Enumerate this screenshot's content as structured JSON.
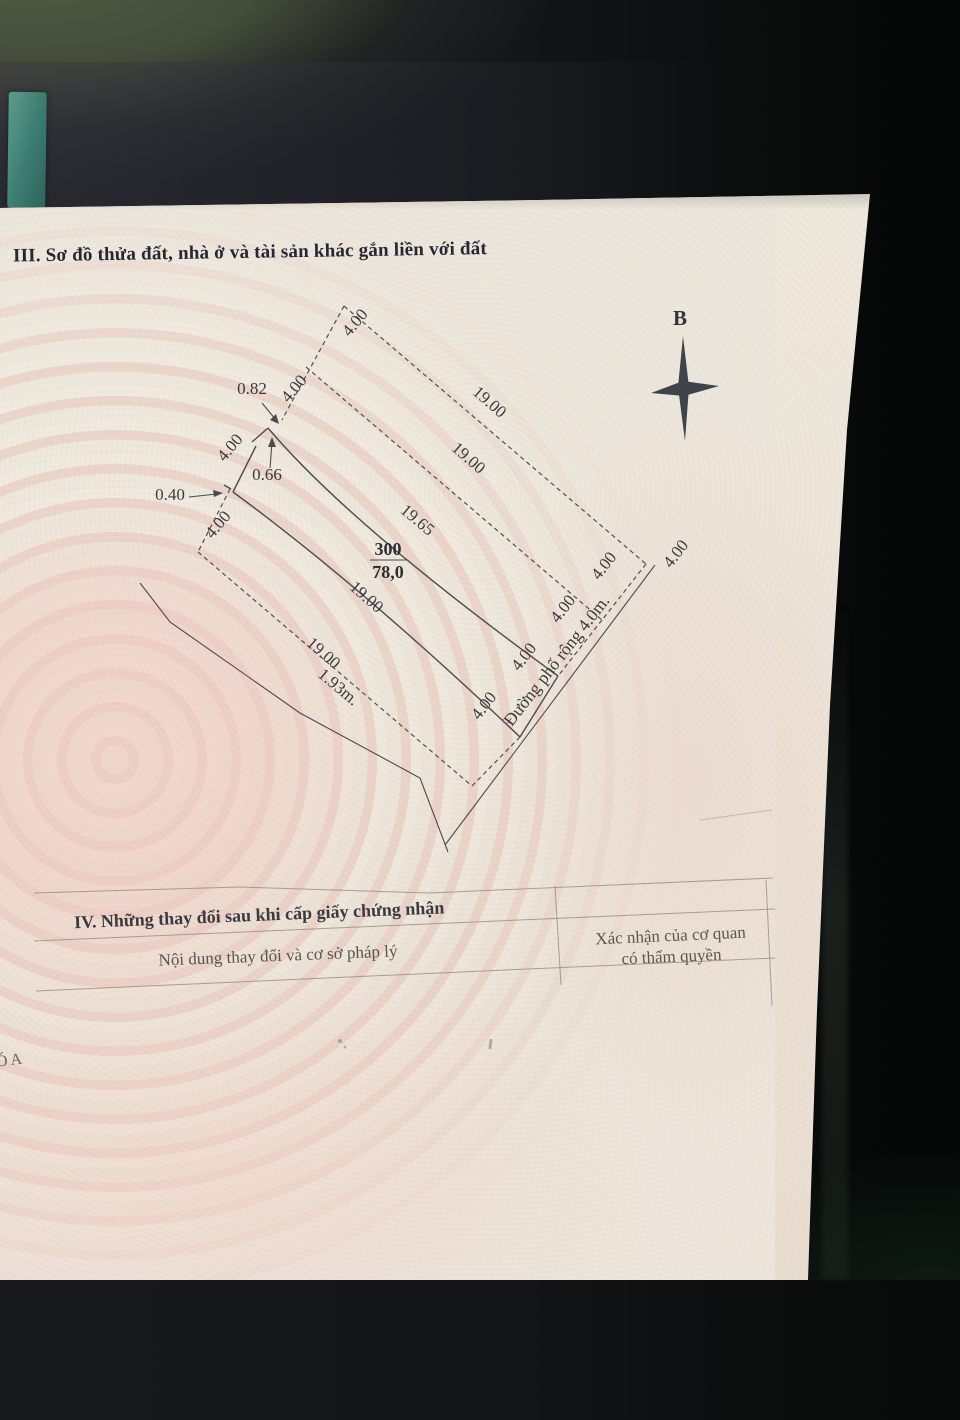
{
  "section3": {
    "title": "III. Sơ đồ thửa đất, nhà ở và tài sản khác gắn liền với đất"
  },
  "diagram": {
    "north_label": "B",
    "parcel_number": "300",
    "parcel_area": "78,0",
    "street_label": "Đường phố rộng 4.0m.",
    "dims": [
      {
        "text": "19.00",
        "x": 486,
        "y": 406,
        "r": 41
      },
      {
        "text": "19.00",
        "x": 465,
        "y": 462,
        "r": 41
      },
      {
        "text": "19.65",
        "x": 414,
        "y": 524,
        "r": 40
      },
      {
        "text": "19.00",
        "x": 363,
        "y": 601,
        "r": 41
      },
      {
        "text": "19.00",
        "x": 320,
        "y": 657,
        "r": 41
      },
      {
        "text": "1.93m.",
        "x": 335,
        "y": 691,
        "r": 40
      },
      {
        "text": "0.82",
        "x": 252,
        "y": 394,
        "r": 0
      },
      {
        "text": "0.66",
        "x": 267,
        "y": 480,
        "r": 0
      },
      {
        "text": "0.40",
        "x": 170,
        "y": 500,
        "r": 0
      },
      {
        "text": "4.00",
        "x": 359,
        "y": 326,
        "r": -50
      },
      {
        "text": "4.00",
        "x": 298,
        "y": 392,
        "r": -50
      },
      {
        "text": "4.00",
        "x": 234,
        "y": 451,
        "r": -50
      },
      {
        "text": "4.00",
        "x": 222,
        "y": 528,
        "r": -50
      },
      {
        "text": "4.00",
        "x": 680,
        "y": 557,
        "r": -52
      },
      {
        "text": "4.00",
        "x": 608,
        "y": 569,
        "r": -52
      },
      {
        "text": "4.00",
        "x": 567,
        "y": 612,
        "r": -52
      },
      {
        "text": "4.00",
        "x": 528,
        "y": 660,
        "r": -52
      },
      {
        "text": "4.00",
        "x": 488,
        "y": 709,
        "r": -52
      }
    ]
  },
  "section4": {
    "title": "IV. Những thay đổi sau khi cấp giấy chứng nhận",
    "col1_header": "Nội dung thay đổi và cơ sở pháp lý",
    "col2_header_line1": "Xác nhận của cơ quan",
    "col2_header_line2": "có thẩm quyền"
  },
  "corner_fragment": "ÓA"
}
